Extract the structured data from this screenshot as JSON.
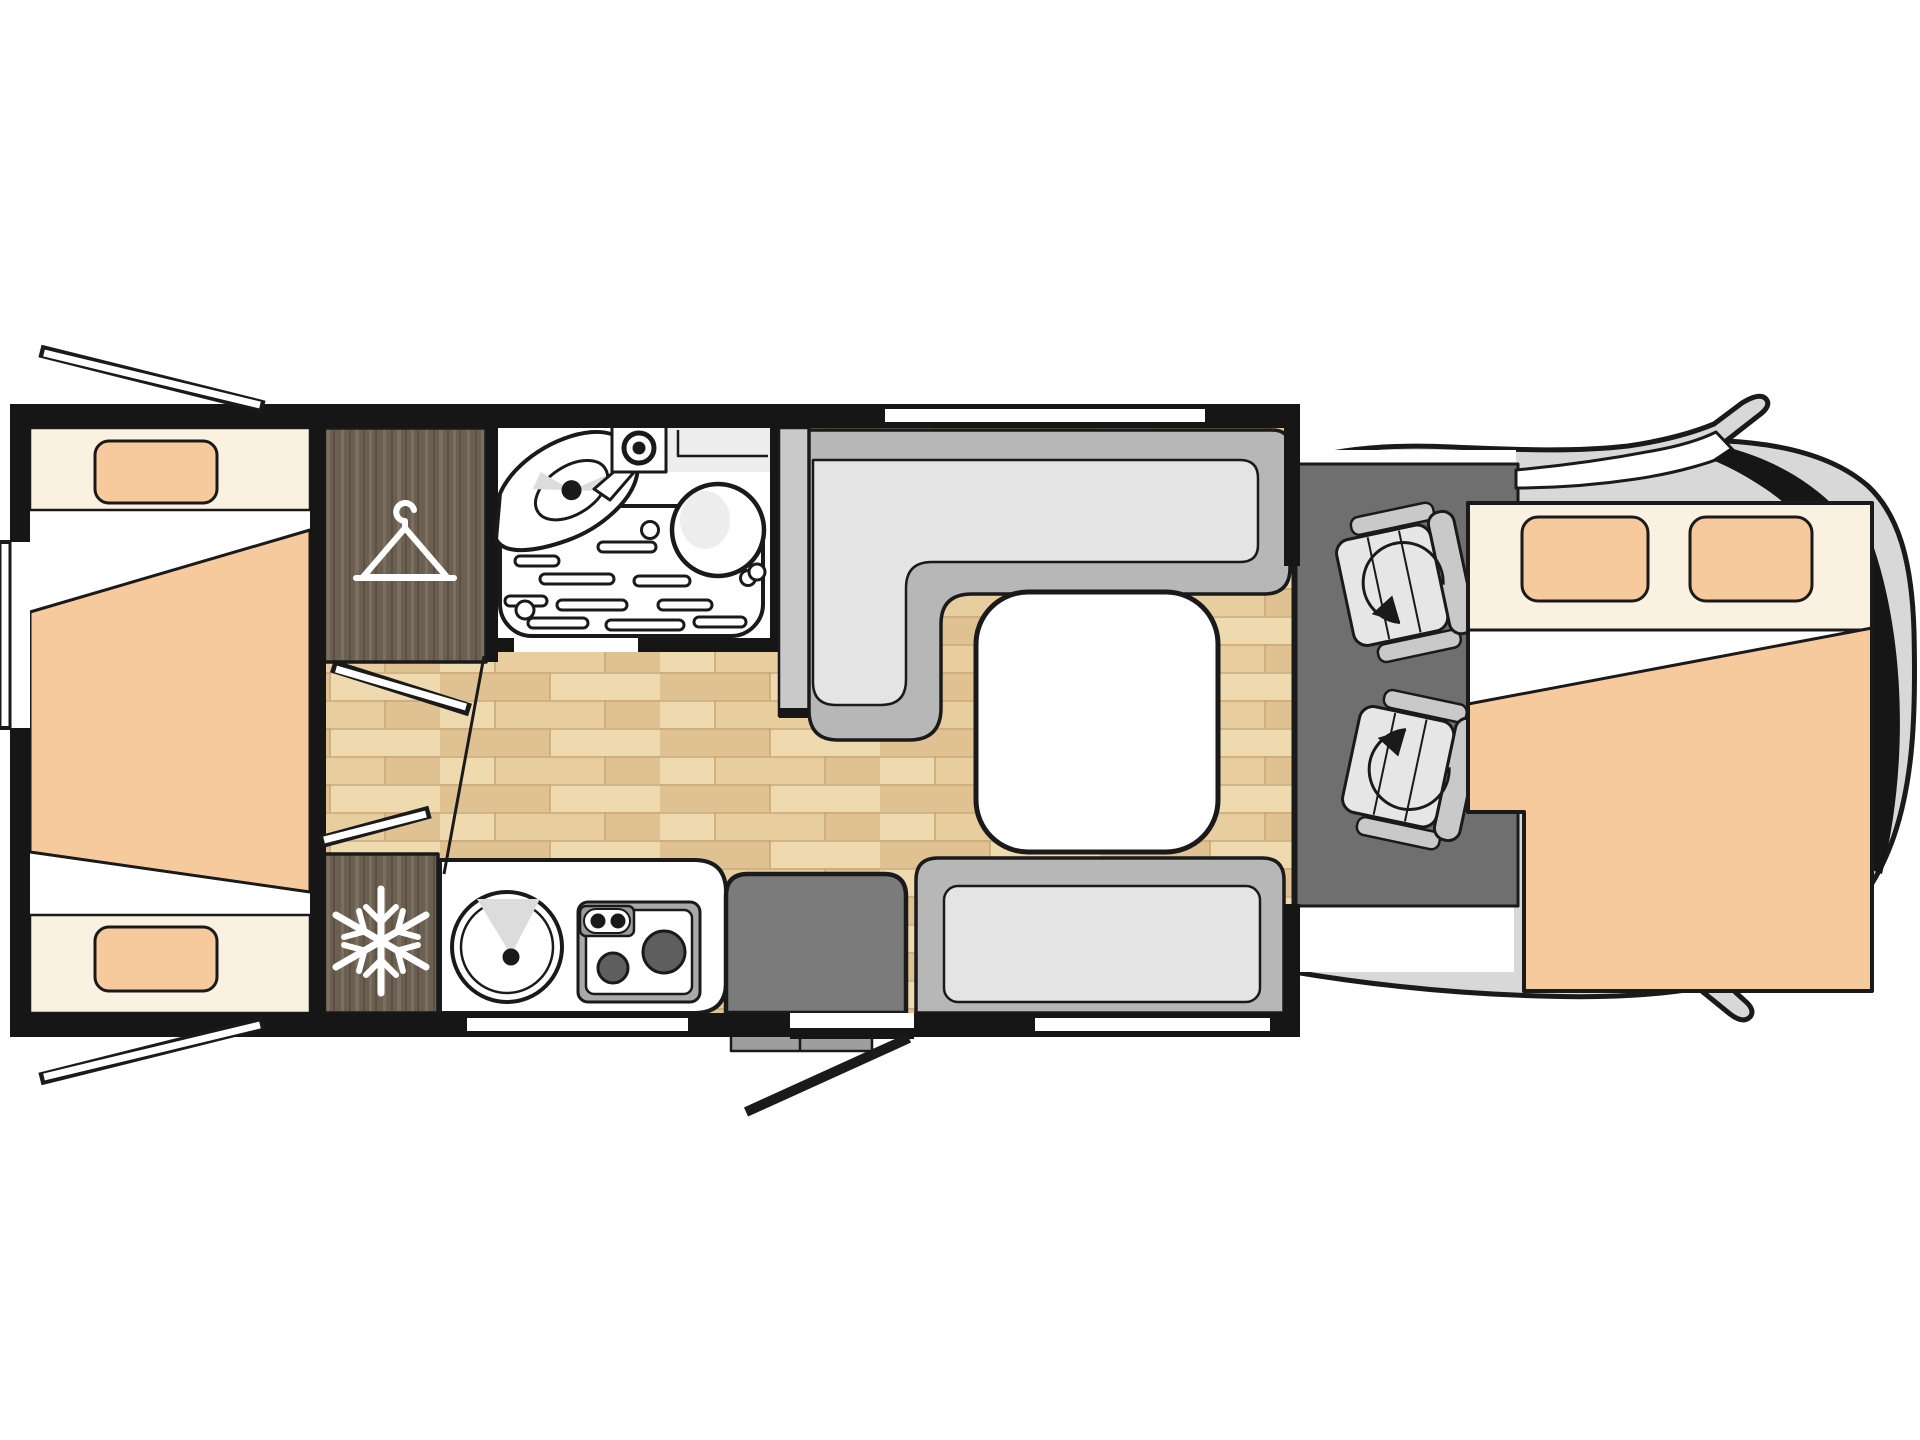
{
  "colors": {
    "line": "#1a1a1a",
    "wall": "#161616",
    "white": "#ffffff",
    "wood_base": "#e8cd9f",
    "wood_dark": "#dfc192",
    "wood_light": "#efd9ae",
    "wood_line": "#c9a878",
    "dwood_base": "#6b5f51",
    "dwood_light": "#7b6f60",
    "dwood_dark": "#5c5144",
    "cream": "#fbf1e1",
    "peach": "#f6ca9c",
    "bench_outer": "#b7b7b7",
    "bench_cushion": "#e4e4e4",
    "partition": "#c9c9c9",
    "cab_floor": "#6f6f6f",
    "body_gray": "#d8d8d8",
    "seat_gray": "#c9c9c9",
    "seat_cushion": "#e6e6e6",
    "step_gray": "#7b7b7b",
    "hob_frame": "#a9a9a9",
    "burner": "#5e5e5e",
    "knob_panel": "#9b9b9b",
    "highlight": "#dcdcdc",
    "soft": "#ededed",
    "tab_gray": "#9e9e9e"
  },
  "plan": {
    "type": "motorhome-floor-plan",
    "view": "top-down",
    "zones": [
      {
        "name": "rear-bedroom",
        "beds": 2,
        "pillows": 2,
        "windows": 3
      },
      {
        "name": "wardrobe",
        "icon": "hanger-icon"
      },
      {
        "name": "bathroom",
        "fixtures": [
          "washbasin",
          "faucet",
          "toilet",
          "shower-tray"
        ]
      },
      {
        "name": "kitchen",
        "appliances": [
          "refrigerator",
          "round-sink",
          "two-burner-hob"
        ],
        "icon": "snowflake-icon"
      },
      {
        "name": "dinette",
        "furniture": [
          "l-shaped-bench",
          "side-bench",
          "table"
        ]
      },
      {
        "name": "entrance",
        "features": [
          "entry-step",
          "open-door"
        ]
      },
      {
        "name": "cab",
        "swivel_seats": 2,
        "icon": "rotation-arrow-icon"
      },
      {
        "name": "drop-down-bed",
        "pillows": 2
      }
    ]
  }
}
